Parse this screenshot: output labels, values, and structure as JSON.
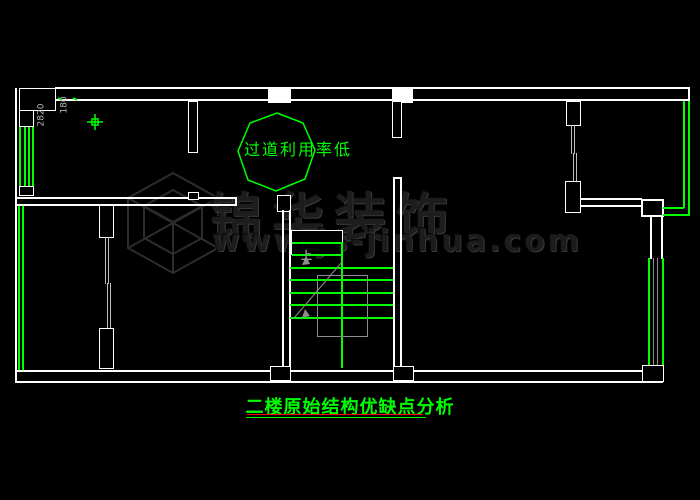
{
  "drawing": {
    "type": "cad-floor-plan",
    "background": "#000000",
    "title": "二楼原始结构优缺点分析",
    "annotations": {
      "corridor_note": "过道利用率低",
      "stair_up_label": "上",
      "dim_label_left": "2820",
      "dim_label_right": "180"
    },
    "watermark": {
      "brand": "锦华装饰",
      "url": "www.js-jinhua.com",
      "logo": "isometric-cube-logo"
    },
    "colors": {
      "wall_line": "#ffffff",
      "annotation_green": "#00ff00",
      "stair_mark_gray": "#8b8b8b",
      "watermark_gray": "#1d1d1d",
      "title_underline_red": "#ff0000",
      "title_underline_green": "#00ff00"
    }
  }
}
